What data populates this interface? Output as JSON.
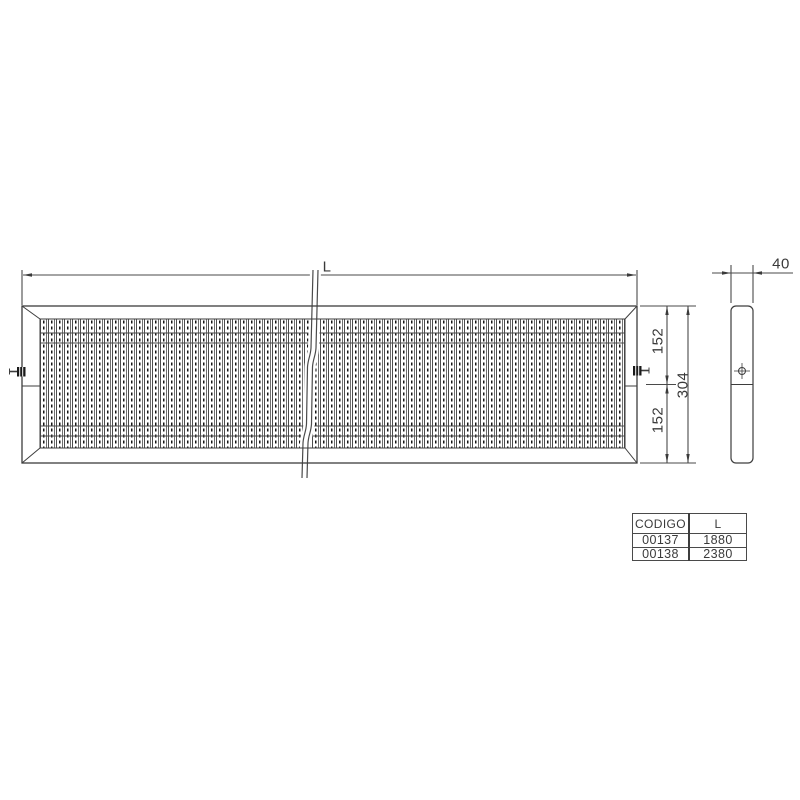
{
  "page": {
    "background": "#ffffff",
    "line_color": "#3d3d3d",
    "text_color": "#3a3a3a"
  },
  "front_view": {
    "length_label": "L",
    "height_top_label": "152",
    "height_total_label": "304",
    "height_bottom_label": "152"
  },
  "side_view": {
    "depth_label": "40"
  },
  "spec_table": {
    "headers": {
      "codigo": "CODIGO",
      "length": "L"
    },
    "rows": [
      {
        "codigo": "00137",
        "length": "1880"
      },
      {
        "codigo": "00138",
        "length": "2380"
      }
    ]
  }
}
